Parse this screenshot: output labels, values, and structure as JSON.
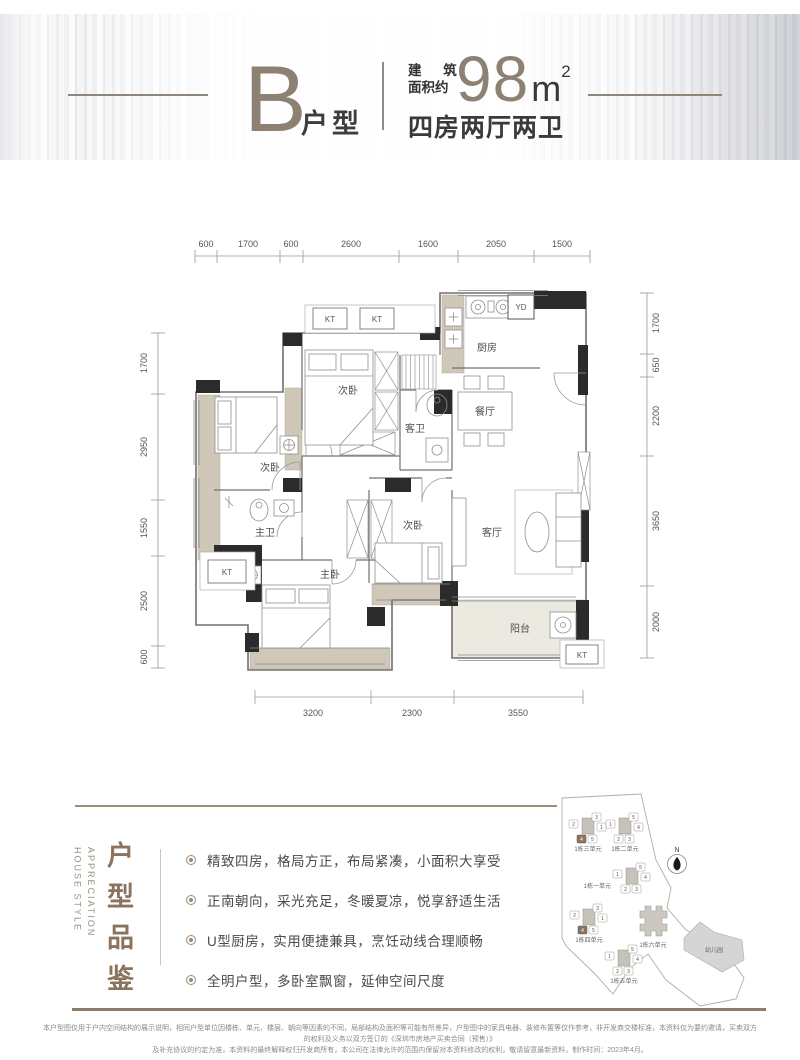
{
  "header": {
    "type_letter": "B",
    "type_suffix": "户型",
    "area_label_line1": "建 筑",
    "area_label_line2": "面积约",
    "area_value": "98",
    "area_unit": "m",
    "area_exponent": "2",
    "layout_summary": "四房两厅两卫"
  },
  "floorplan": {
    "dims_top": [
      "600",
      "1700",
      "600",
      "2600",
      "1600",
      "2050",
      "1500"
    ],
    "dims_left": [
      "1700",
      "2950",
      "1550",
      "2500",
      "600"
    ],
    "dims_right": [
      "1700",
      "650",
      "2200",
      "3650",
      "2000"
    ],
    "dims_bottom": [
      "3200",
      "2300",
      "3550"
    ],
    "rooms": {
      "bedroom_top": "次卧",
      "bedroom_left": "次卧",
      "bedroom_mid": "次卧",
      "master_bedroom": "主卧",
      "master_bath": "主卫",
      "guest_bath": "客卫",
      "kitchen": "厨房",
      "dining": "餐厅",
      "living": "客厅",
      "balcony": "阳台"
    },
    "ac_unit_label": "KT",
    "flue_label": "YD"
  },
  "appreciation": {
    "title_en_line1": "HOUSE STYLE",
    "title_en_line2": "APPRECIATION",
    "title_cn": "户型品鉴",
    "bullets": [
      "精致四房，格局方正，布局紧凑，小面积大享受",
      "正南朝向，采光充足，冬暖夏凉，悦享舒适生活",
      "U型厨房，实用便捷兼具，烹饪动线合理顺畅",
      "全明户型，多卧室飘窗，延伸空间尺度"
    ]
  },
  "siteplan": {
    "north_label": "N",
    "kindergarten_label": "幼儿园",
    "clusters": [
      {
        "label": "1栋三单元",
        "units": [
          "2",
          "3",
          "1",
          "4",
          "5"
        ],
        "highlighted_unit": "4"
      },
      {
        "label": "1栋二单元",
        "units": [
          "1",
          "5",
          "4",
          "2",
          "3"
        ],
        "highlighted_unit": ""
      },
      {
        "label": "1栋一单元",
        "units": [
          "1",
          "5",
          "4",
          "2",
          "3"
        ],
        "highlighted_unit": ""
      },
      {
        "label": "1栋四单元",
        "units": [
          "2",
          "3",
          "1",
          "4",
          "5"
        ],
        "highlighted_unit": "4"
      },
      {
        "label": "1栋五单元",
        "units": [
          "1",
          "5",
          "4",
          "2",
          "3"
        ],
        "highlighted_unit": ""
      },
      {
        "label": "1栋六单元",
        "units": [],
        "highlighted_unit": ""
      }
    ]
  },
  "disclaimer": {
    "line1": "本户型图仅用于户内空间结构的展示说明，相同户型单位因楼栋、单元、楼层、朝向等因素的不同，局部结构及面积等可能有所差异，户型图中的家具电器、装修布置等仅作参考，非开发商交楼标准，本资料仅为要约邀请，买卖双方的权利及义务以双方签订的《深圳市房地产买卖合同（预售）》",
    "line2": "及补充协议的约定为准，本资料的最终解释权归开发商所有，本公司在法律允许的范围内保留对本资料修改的权利，敬请留意最新资料，制作时间：2023年4月。"
  },
  "colors": {
    "accent_brown": "#8a7460",
    "taupe": "#8d8173",
    "wall_black": "#2b2b2b",
    "beige": "#cfc7b7",
    "text_dark": "#3a3a3a"
  }
}
